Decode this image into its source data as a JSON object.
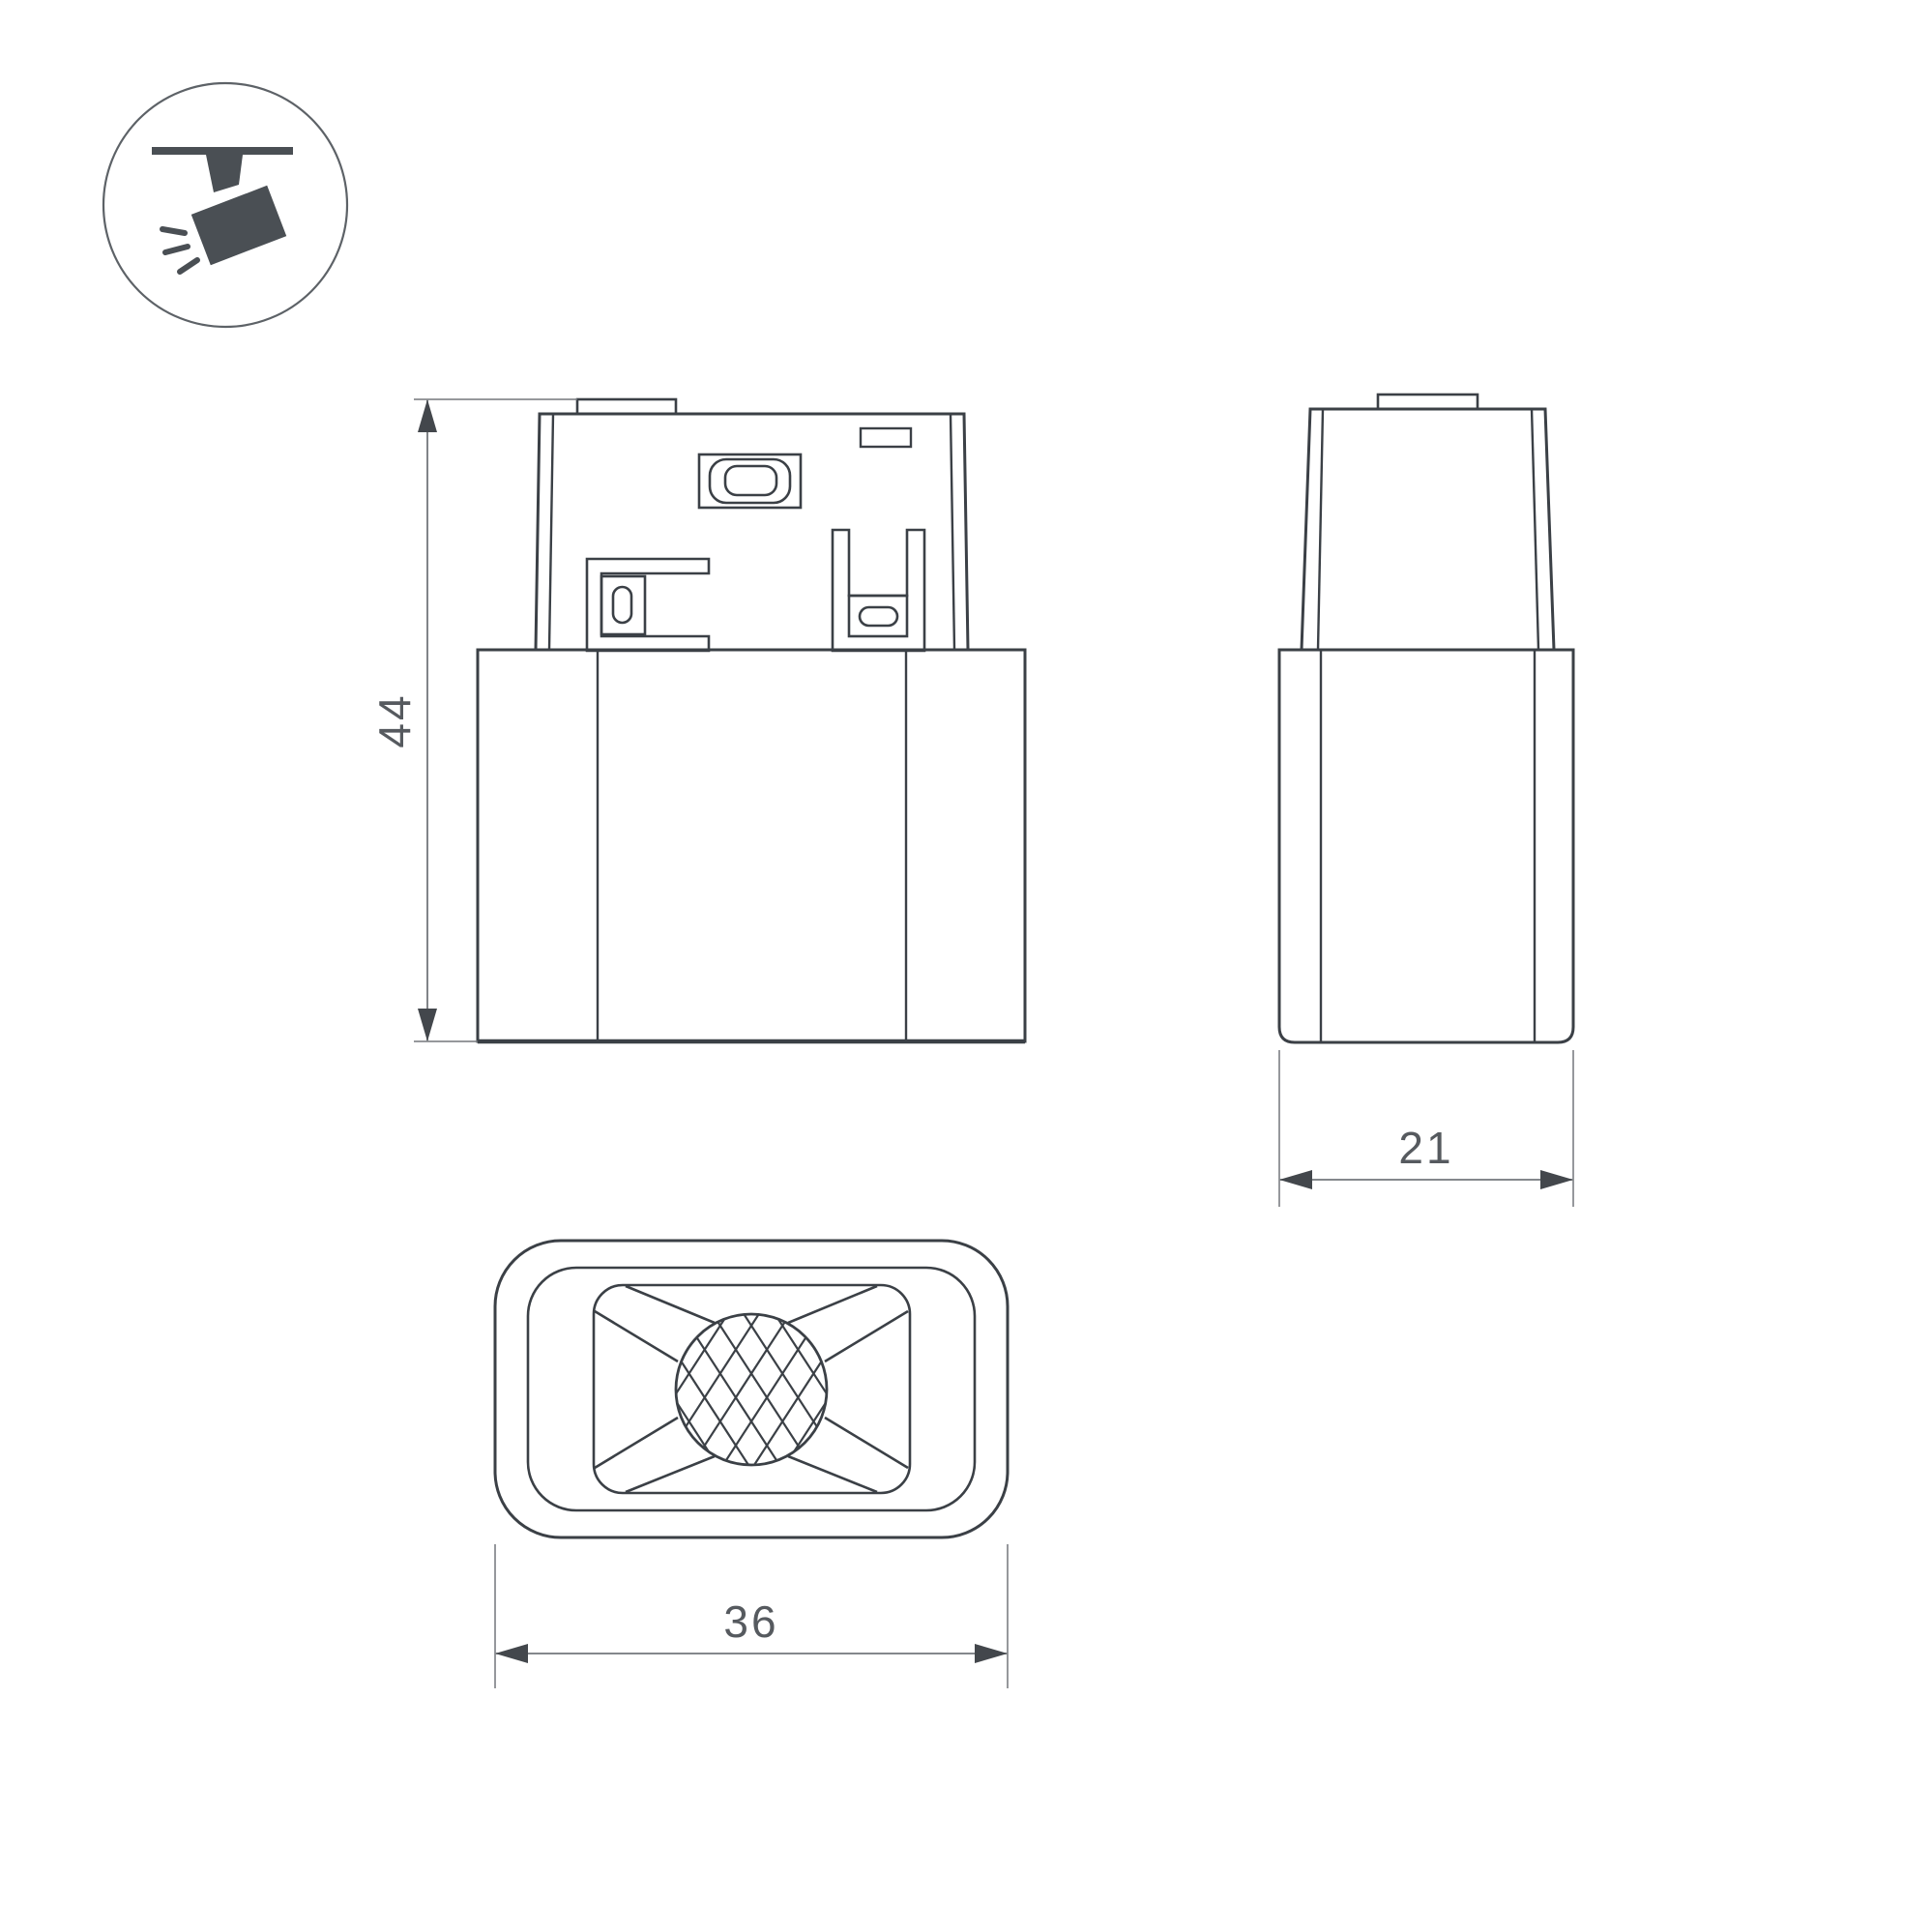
{
  "drawing": {
    "type": "technical-dimension-drawing",
    "views": [
      "front",
      "side",
      "bottom"
    ]
  },
  "icon": {
    "name": "track-spotlight",
    "fill_color": "#4a4f54",
    "circle_color": "#5d6267"
  },
  "dimensions": {
    "height": {
      "value": "44"
    },
    "depth": {
      "value": "21"
    },
    "width": {
      "value": "36"
    }
  },
  "colors": {
    "outline": "#3b4046",
    "detail": "#43484d",
    "dimension_line": "#73777b",
    "arrow_fill": "#43474c",
    "text": "#565a5f"
  }
}
